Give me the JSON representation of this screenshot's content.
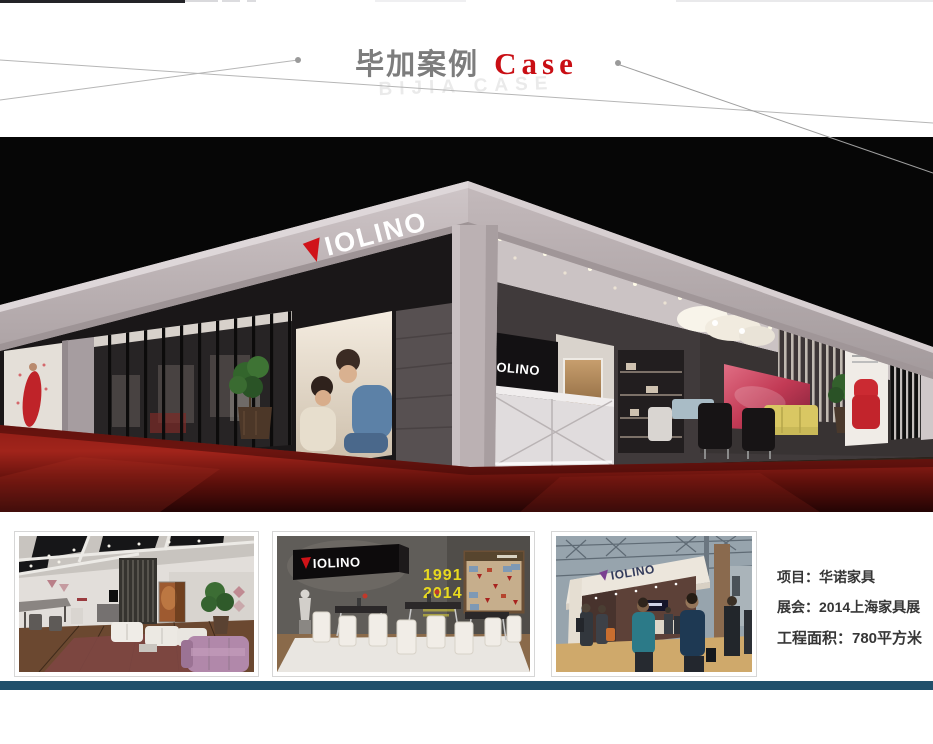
{
  "page": {
    "background": "#ffffff",
    "accent_red": "#c90e14",
    "footer_bar_color": "#21506b"
  },
  "header": {
    "title_cn": "毕加案例",
    "title_en": "Case",
    "watermark": "BIJIA CASE"
  },
  "hero": {
    "alt": "3D render of VIOLINO furniture exhibition booth on red carpet, night scene",
    "brand": "VIOLINO",
    "fascia_letters": "IOLINO",
    "wall_sign_letters": "OLINO",
    "colors": {
      "background": "#060606",
      "carpet_red": "#9e241b",
      "frame_gray": "#bdb3b5",
      "logo_triangle": "#d01319"
    }
  },
  "thumbnails": [
    {
      "alt": "showroom interior render with white and purple sofas"
    },
    {
      "alt": "dining area render with VIOLINO sign and timeline wall",
      "sign_letters": "IOLINO",
      "year_start": "1991",
      "year_end": "2014",
      "years_color": "#e8d91f"
    },
    {
      "alt": "photo of VIOLINO booth at exhibition with visitors",
      "sign_letters": "IOLINO"
    }
  ],
  "project_info": {
    "line1": "项目：华诺家具",
    "line2": "展会：2014上海家具展",
    "line3": "工程面积：780平方米"
  }
}
